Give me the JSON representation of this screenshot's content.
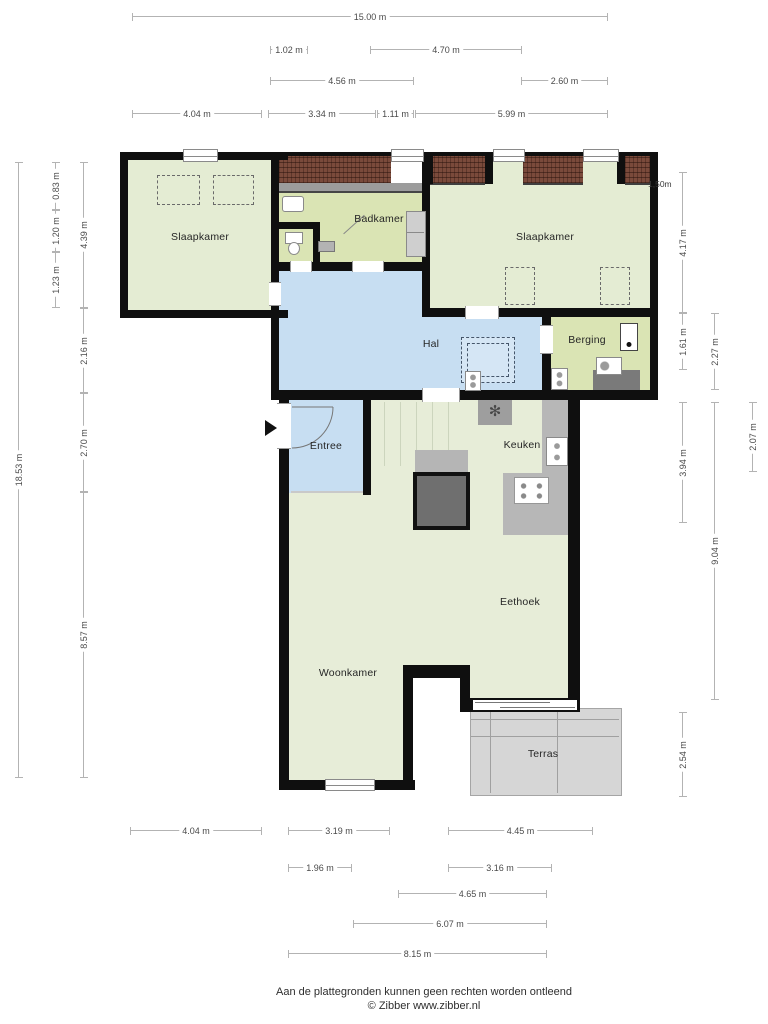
{
  "rooms": {
    "slaapkamer_left": "Slaapkamer",
    "badkamer": "Badkamer",
    "slaapkamer_right": "Slaapkamer",
    "hal": "Hal",
    "berging": "Berging",
    "entree": "Entree",
    "keuken": "Keuken",
    "eethoek": "Eethoek",
    "woonkamer": "Woonkamer",
    "terras": "Terras"
  },
  "annotations": {
    "knee_wall_height": "1,50m"
  },
  "dimensions": {
    "top": [
      {
        "label": "15.00 m"
      },
      {
        "label": "1.02 m"
      },
      {
        "label": "4.70 m"
      },
      {
        "label": "4.56 m"
      },
      {
        "label": "2.60 m"
      },
      {
        "label": "4.04 m"
      },
      {
        "label": "3.34 m"
      },
      {
        "label": "1.11 m"
      },
      {
        "label": "5.99 m"
      }
    ],
    "bottom": [
      {
        "label": "4.04 m"
      },
      {
        "label": "3.19 m"
      },
      {
        "label": "4.45 m"
      },
      {
        "label": "1.96 m"
      },
      {
        "label": "3.16 m"
      },
      {
        "label": "4.65 m"
      },
      {
        "label": "6.07 m"
      },
      {
        "label": "8.15 m"
      }
    ],
    "left": [
      {
        "label": "18.53 m"
      },
      {
        "label": "0.83 m"
      },
      {
        "label": "1.20 m"
      },
      {
        "label": "1.23 m"
      },
      {
        "label": "4.39 m"
      },
      {
        "label": "2.16 m"
      },
      {
        "label": "2.70 m"
      },
      {
        "label": "8.57 m"
      }
    ],
    "right": [
      {
        "label": "4.17 m"
      },
      {
        "label": "1.61 m"
      },
      {
        "label": "3.94 m"
      },
      {
        "label": "2.27 m"
      },
      {
        "label": "9.04 m"
      },
      {
        "label": "2.07 m"
      },
      {
        "label": "2.54 m"
      }
    ]
  },
  "footer": {
    "line1": "Aan de plattegronden kunnen geen rechten worden ontleend",
    "line2": "© Zibber www.zibber.nl"
  },
  "colors": {
    "wall": "#0f0f0f",
    "room_green": "#e4ecd3",
    "service_green": "#dae4b4",
    "hall_blue": "#c7def2",
    "terrace_gray": "#d6d6d6",
    "roof_tile": "#7a4a3b"
  }
}
